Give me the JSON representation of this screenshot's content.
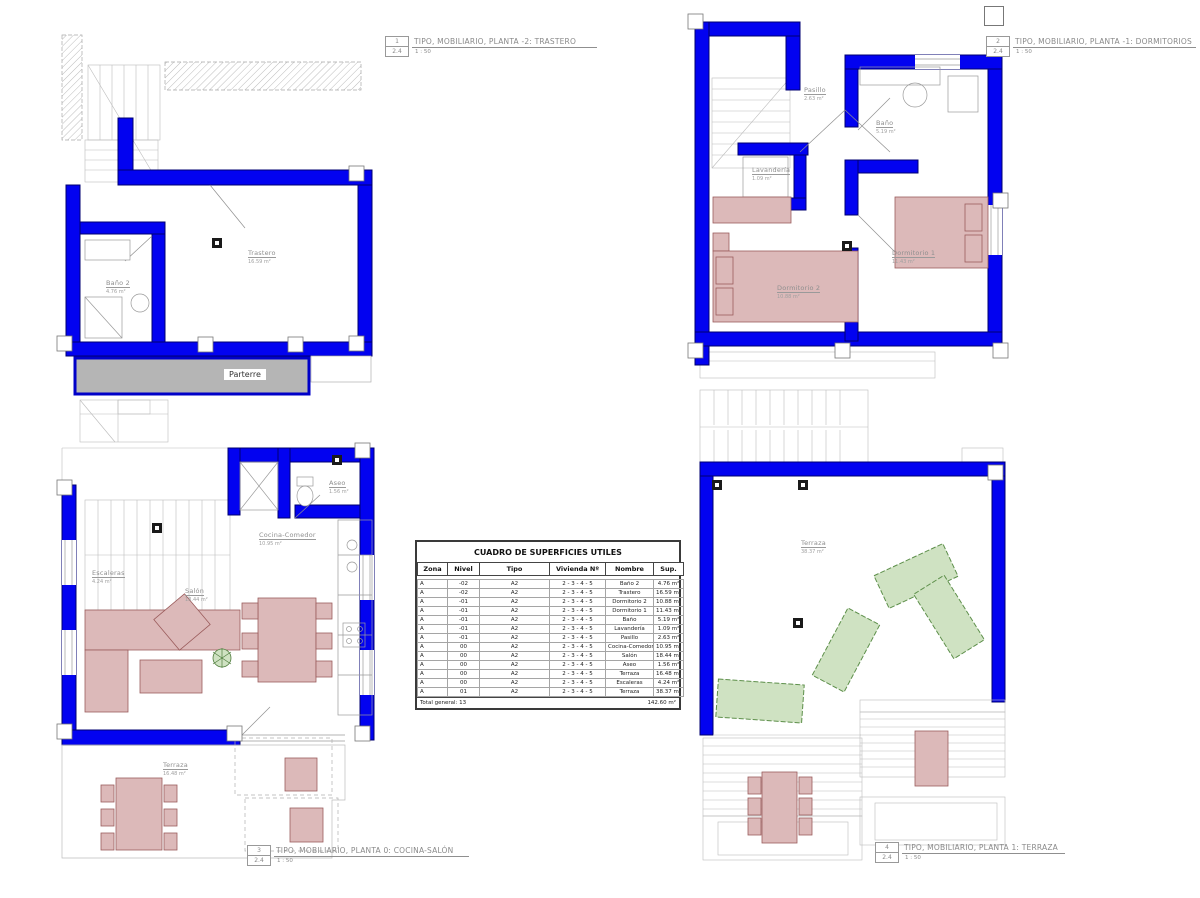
{
  "colors": {
    "wall_blue": "#0202f0",
    "wall_blue_dark": "#000070",
    "furniture_pink": "#dcb9b9",
    "furniture_pink_stroke": "#9b5c5c",
    "furniture_green": "#cfe2c2",
    "furniture_green_stroke": "#5d8f4a",
    "parterre_gray": "#b5b5b5",
    "line_gray": "#b8b8b8",
    "label_gray": "#8f8f8f"
  },
  "plans": [
    {
      "number": "1",
      "sheet": "2.4",
      "title": "TIPO, MOBILIARIO, PLANTA -2: TRASTERO",
      "scale": "1 : 50",
      "parterre_label": "Parterre",
      "rooms": [
        {
          "name": "Trastero",
          "area": "16.59 m²"
        },
        {
          "name": "Baño 2",
          "area": "4.76 m²"
        }
      ]
    },
    {
      "number": "2",
      "sheet": "2.4",
      "title": "TIPO, MOBILIARIO, PLANTA -1: DORMITORIOS",
      "scale": "1 : 50",
      "rooms": [
        {
          "name": "Pasillo",
          "area": "2.63 m²"
        },
        {
          "name": "Baño",
          "area": "5.19 m²"
        },
        {
          "name": "Lavandería",
          "area": "1.09 m²"
        },
        {
          "name": "Dormitorio 1",
          "area": "11.43 m²"
        },
        {
          "name": "Dormitorio 2",
          "area": "10.88 m²"
        }
      ]
    },
    {
      "number": "3",
      "sheet": "2.4",
      "title": "TIPO, MOBILIARIO, PLANTA 0: COCINA-SALÓN",
      "scale": "1 : 50",
      "rooms": [
        {
          "name": "Escaleras",
          "area": "4.24 m²"
        },
        {
          "name": "Aseo",
          "area": "1.56 m²"
        },
        {
          "name": "Cocina-Comedor",
          "area": "10.95 m²"
        },
        {
          "name": "Salón",
          "area": "18.44 m²"
        },
        {
          "name": "Terraza",
          "area": "16.48 m²"
        }
      ]
    },
    {
      "number": "4",
      "sheet": "2.4",
      "title": "TIPO, MOBILIARIO, PLANTA 1: TERRAZA",
      "scale": "1 : 50",
      "rooms": [
        {
          "name": "Terraza",
          "area": "38.37 m²"
        }
      ]
    }
  ],
  "table": {
    "title": "CUADRO DE SUPERFICIES UTILES",
    "headers": [
      "Zona",
      "Nivel",
      "Tipo",
      "Vivienda Nº",
      "Nombre",
      "Sup."
    ],
    "rows": [
      [
        "A",
        "-02",
        "A2",
        "2 - 3 - 4 - 5",
        "Baño 2",
        "4.76 m²"
      ],
      [
        "A",
        "-02",
        "A2",
        "2 - 3 - 4 - 5",
        "Trastero",
        "16.59 m²"
      ],
      [
        "A",
        "-01",
        "A2",
        "2 - 3 - 4 - 5",
        "Dormitorio 2",
        "10.88 m²"
      ],
      [
        "A",
        "-01",
        "A2",
        "2 - 3 - 4 - 5",
        "Dormitorio 1",
        "11.43 m²"
      ],
      [
        "A",
        "-01",
        "A2",
        "2 - 3 - 4 - 5",
        "Baño",
        "5.19 m²"
      ],
      [
        "A",
        "-01",
        "A2",
        "2 - 3 - 4 - 5",
        "Lavandería",
        "1.09 m²"
      ],
      [
        "A",
        "-01",
        "A2",
        "2 - 3 - 4 - 5",
        "Pasillo",
        "2.63 m²"
      ],
      [
        "A",
        "00",
        "A2",
        "2 - 3 - 4 - 5",
        "Cocina-Comedor",
        "10.95 m²"
      ],
      [
        "A",
        "00",
        "A2",
        "2 - 3 - 4 - 5",
        "Salón",
        "18.44 m²"
      ],
      [
        "A",
        "00",
        "A2",
        "2 - 3 - 4 - 5",
        "Aseo",
        "1.56 m²"
      ],
      [
        "A",
        "00",
        "A2",
        "2 - 3 - 4 - 5",
        "Terraza",
        "16.48 m²"
      ],
      [
        "A",
        "00",
        "A2",
        "2 - 3 - 4 - 5",
        "Escaleras",
        "4.24 m²"
      ],
      [
        "A",
        "01",
        "A2",
        "2 - 3 - 4 - 5",
        "Terraza",
        "38.37 m²"
      ]
    ],
    "total_label": "Total general: 13",
    "total_value": "142.60 m²"
  }
}
